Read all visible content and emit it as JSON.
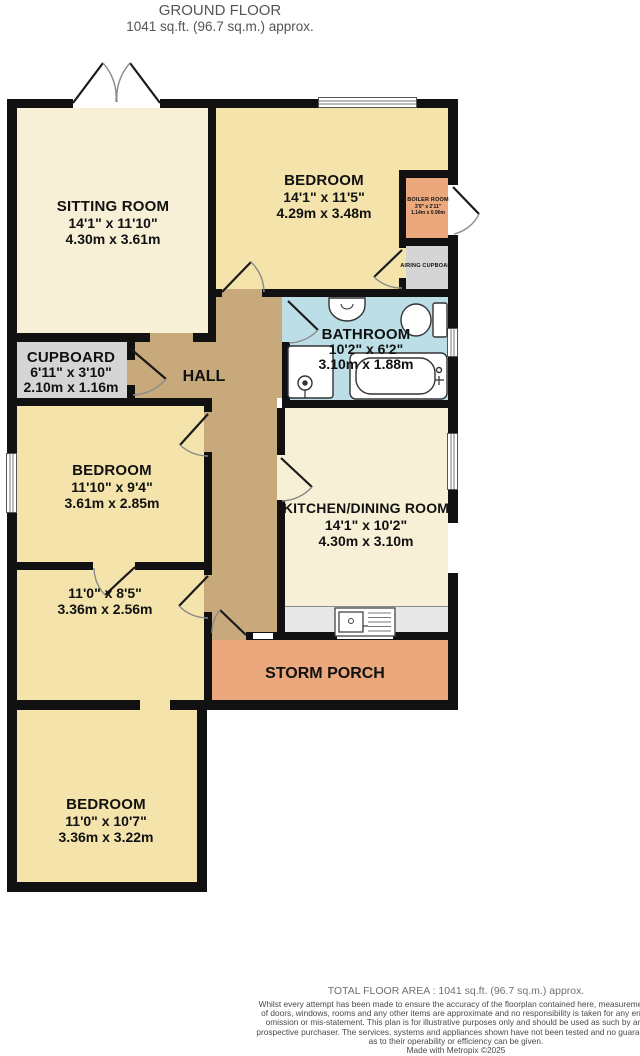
{
  "title": {
    "line1": "GROUND FLOOR",
    "line2": "1041 sq.ft. (96.7 sq.m.) approx."
  },
  "rooms": {
    "sitting_room": {
      "name": "SITTING ROOM",
      "imperial": "14'1\" x 11'10\"",
      "metric": "4.30m x 3.61m"
    },
    "bedroom_1": {
      "name": "BEDROOM",
      "imperial": "14'1\" x 11'5\"",
      "metric": "4.29m x 3.48m"
    },
    "boiler_room": {
      "name": "BOILER ROOM",
      "imperial": "3'9\" x 2'11\"",
      "metric": "1.14m x 0.90m"
    },
    "airing_cupboard": {
      "name": "AIRING CUPBOARD"
    },
    "bathroom": {
      "name": "BATHROOM",
      "imperial": "10'2\" x 6'2\"",
      "metric": "3.10m x 1.88m"
    },
    "cupboard": {
      "name": "CUPBOARD",
      "imperial": "6'11\" x 3'10\"",
      "metric": "2.10m x 1.16m"
    },
    "hall": {
      "name": "HALL"
    },
    "bedroom_2": {
      "name": "BEDROOM",
      "imperial": "11'10\" x 9'4\"",
      "metric": "3.61m x 2.85m"
    },
    "kitchen_dining": {
      "name": "KITCHEN/DINING ROOM",
      "imperial": "14'1\" x 10'2\"",
      "metric": "4.30m x 3.10m"
    },
    "store_room": {
      "imperial": "11'0\" x 8'5\"",
      "metric": "3.36m x 2.56m"
    },
    "storm_porch": {
      "name": "STORM PORCH"
    },
    "bedroom_3": {
      "name": "BEDROOM",
      "imperial": "11'0\" x 10'7\"",
      "metric": "3.36m x 3.22m"
    }
  },
  "footer": {
    "total_area": "TOTAL FLOOR AREA : 1041 sq.ft. (96.7 sq.m.) approx.",
    "disclaimer_line1": "Whilst every attempt has been made to ensure the accuracy of the floorplan contained here, measurements",
    "disclaimer_line2": "of doors, windows, rooms and any other items are approximate and no responsibility is taken for any error,",
    "disclaimer_line3": "omission or mis-statement. This plan is for illustrative purposes only and should be used as such by any",
    "disclaimer_line4": "prospective purchaser. The services, systems and appliances shown have not been tested and no guarantee",
    "disclaimer_line5": "as to their operability or efficiency can be given.",
    "made_with": "Made with Metropix ©2025"
  },
  "colors": {
    "room_cream": "#f7efd6",
    "room_yellow": "#f4e4ab",
    "hall_brown": "#c7a97c",
    "porch_orange": "#eaa87c",
    "cupboard_gray": "#d5d5d5",
    "bathroom_blue": "#bcdfe7",
    "wall": "#111111"
  }
}
